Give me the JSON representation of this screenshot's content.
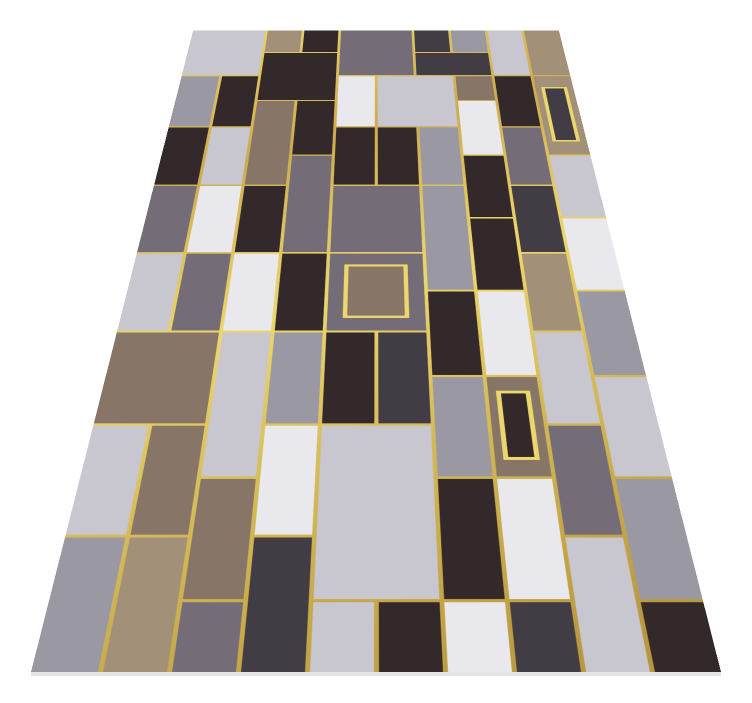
{
  "scene": {
    "background": "#ffffff",
    "description": "geometric-mosaic-rug-product-image"
  },
  "rug": {
    "palette": {
      "dark": "#33282a",
      "charcoal": "#423c44",
      "gray": "#746d77",
      "silver": "#9a98a2",
      "lightgray": "#c8c6ce",
      "white": "#e9e8ec",
      "taupe": "#877668",
      "tan": "#a29079",
      "gold": "#cdab50",
      "gold_light": "#ecd76c",
      "gold_dark": "#b39138"
    },
    "grid": {
      "cols": 10,
      "rows": 16,
      "cell_w": 69,
      "cell_h": 107
    },
    "perspective": {
      "width": 690,
      "center_x": 376,
      "bottom_y": 672,
      "top_y": 30,
      "top_width": 366,
      "rotate_x_deg": 45,
      "perspective_px": 1365
    },
    "line_half_width": 2.5,
    "tiles": [
      {
        "x": 0,
        "y": 0,
        "w": 2,
        "h": 2,
        "color": "lightgray"
      },
      {
        "x": 2,
        "y": 0,
        "w": 1,
        "h": 1,
        "color": "tan"
      },
      {
        "x": 3,
        "y": 0,
        "w": 1,
        "h": 1,
        "color": "dark"
      },
      {
        "x": 4,
        "y": 0,
        "w": 2,
        "h": 2,
        "color": "gray"
      },
      {
        "x": 6,
        "y": 0,
        "w": 1,
        "h": 1,
        "color": "charcoal"
      },
      {
        "x": 7,
        "y": 0,
        "w": 1,
        "h": 1,
        "color": "silver"
      },
      {
        "x": 8,
        "y": 0,
        "w": 1,
        "h": 2,
        "color": "lightgray"
      },
      {
        "x": 9,
        "y": 0,
        "w": 1,
        "h": 2,
        "color": "tan"
      },
      {
        "x": 2,
        "y": 1,
        "w": 2,
        "h": 2,
        "color": "dark"
      },
      {
        "x": 6,
        "y": 1,
        "w": 2,
        "h": 1,
        "color": "charcoal"
      },
      {
        "x": 0,
        "y": 2,
        "w": 1,
        "h": 2,
        "color": "silver"
      },
      {
        "x": 1,
        "y": 2,
        "w": 1,
        "h": 2,
        "color": "dark"
      },
      {
        "x": 4,
        "y": 2,
        "w": 1,
        "h": 2,
        "color": "white"
      },
      {
        "x": 5,
        "y": 2,
        "w": 2,
        "h": 2,
        "color": "lightgray"
      },
      {
        "x": 7,
        "y": 2,
        "w": 1,
        "h": 1,
        "color": "taupe"
      },
      {
        "x": 8,
        "y": 2,
        "w": 1,
        "h": 2,
        "color": "dark"
      },
      {
        "x": 9,
        "y": 2,
        "w": 1,
        "h": 3,
        "color": "tan",
        "inset": "charcoal"
      },
      {
        "x": 2,
        "y": 3,
        "w": 1,
        "h": 3,
        "color": "taupe"
      },
      {
        "x": 3,
        "y": 3,
        "w": 1,
        "h": 2,
        "color": "dark"
      },
      {
        "x": 7,
        "y": 3,
        "w": 1,
        "h": 2,
        "color": "white"
      },
      {
        "x": 0,
        "y": 4,
        "w": 1,
        "h": 2,
        "color": "dark"
      },
      {
        "x": 1,
        "y": 4,
        "w": 1,
        "h": 2,
        "color": "lightgray"
      },
      {
        "x": 4,
        "y": 4,
        "w": 1,
        "h": 2,
        "color": "dark"
      },
      {
        "x": 5,
        "y": 4,
        "w": 1,
        "h": 2,
        "color": "dark"
      },
      {
        "x": 6,
        "y": 4,
        "w": 1,
        "h": 2,
        "color": "silver"
      },
      {
        "x": 8,
        "y": 4,
        "w": 1,
        "h": 2,
        "color": "gray"
      },
      {
        "x": 7,
        "y": 5,
        "w": 1,
        "h": 2,
        "color": "dark"
      },
      {
        "x": 9,
        "y": 5,
        "w": 1,
        "h": 2,
        "color": "lightgray"
      },
      {
        "x": 3,
        "y": 5,
        "w": 1,
        "h": 3,
        "color": "gray"
      },
      {
        "x": 0,
        "y": 6,
        "w": 1,
        "h": 2,
        "color": "gray"
      },
      {
        "x": 1,
        "y": 6,
        "w": 1,
        "h": 2,
        "color": "white"
      },
      {
        "x": 2,
        "y": 6,
        "w": 1,
        "h": 2,
        "color": "dark"
      },
      {
        "x": 4,
        "y": 6,
        "w": 2,
        "h": 2,
        "color": "gray"
      },
      {
        "x": 6,
        "y": 6,
        "w": 1,
        "h": 3,
        "color": "silver"
      },
      {
        "x": 8,
        "y": 6,
        "w": 1,
        "h": 2,
        "color": "charcoal"
      },
      {
        "x": 7,
        "y": 7,
        "w": 1,
        "h": 2,
        "color": "dark"
      },
      {
        "x": 9,
        "y": 7,
        "w": 1,
        "h": 2,
        "color": "white"
      },
      {
        "x": 0,
        "y": 8,
        "w": 1,
        "h": 2,
        "color": "lightgray"
      },
      {
        "x": 1,
        "y": 8,
        "w": 1,
        "h": 2,
        "color": "gray"
      },
      {
        "x": 2,
        "y": 8,
        "w": 1,
        "h": 2,
        "color": "white"
      },
      {
        "x": 3,
        "y": 8,
        "w": 1,
        "h": 2,
        "color": "dark"
      },
      {
        "x": 4,
        "y": 8,
        "w": 2,
        "h": 2,
        "color": "gray",
        "inset": "taupe"
      },
      {
        "x": 8,
        "y": 8,
        "w": 1,
        "h": 2,
        "color": "tan"
      },
      {
        "x": 6,
        "y": 9,
        "w": 1,
        "h": 2,
        "color": "dark"
      },
      {
        "x": 7,
        "y": 9,
        "w": 1,
        "h": 2,
        "color": "white"
      },
      {
        "x": 9,
        "y": 9,
        "w": 1,
        "h": 2,
        "color": "silver"
      },
      {
        "x": 0,
        "y": 10,
        "w": 2,
        "h": 2,
        "color": "taupe"
      },
      {
        "x": 2,
        "y": 10,
        "w": 1,
        "h": 3,
        "color": "lightgray"
      },
      {
        "x": 3,
        "y": 10,
        "w": 1,
        "h": 2,
        "color": "silver"
      },
      {
        "x": 4,
        "y": 10,
        "w": 1,
        "h": 2,
        "color": "dark"
      },
      {
        "x": 5,
        "y": 10,
        "w": 1,
        "h": 2,
        "color": "charcoal"
      },
      {
        "x": 8,
        "y": 10,
        "w": 1,
        "h": 2,
        "color": "lightgray"
      },
      {
        "x": 6,
        "y": 11,
        "w": 1,
        "h": 2,
        "color": "silver"
      },
      {
        "x": 7,
        "y": 11,
        "w": 1,
        "h": 2,
        "color": "taupe",
        "inset": "dark"
      },
      {
        "x": 9,
        "y": 11,
        "w": 1,
        "h": 2,
        "color": "lightgray"
      },
      {
        "x": 0,
        "y": 12,
        "w": 1,
        "h": 2,
        "color": "lightgray"
      },
      {
        "x": 1,
        "y": 12,
        "w": 1,
        "h": 2,
        "color": "taupe"
      },
      {
        "x": 3,
        "y": 12,
        "w": 1,
        "h": 2,
        "color": "white"
      },
      {
        "x": 4,
        "y": 12,
        "w": 2,
        "h": 3,
        "color": "lightgray"
      },
      {
        "x": 8,
        "y": 12,
        "w": 1,
        "h": 2,
        "color": "gray"
      },
      {
        "x": 2,
        "y": 13,
        "w": 1,
        "h": 2,
        "color": "taupe"
      },
      {
        "x": 6,
        "y": 13,
        "w": 1,
        "h": 2,
        "color": "dark"
      },
      {
        "x": 7,
        "y": 13,
        "w": 1,
        "h": 2,
        "color": "white"
      },
      {
        "x": 9,
        "y": 13,
        "w": 1,
        "h": 2,
        "color": "silver"
      },
      {
        "x": 0,
        "y": 14,
        "w": 1,
        "h": 2,
        "color": "silver"
      },
      {
        "x": 1,
        "y": 14,
        "w": 1,
        "h": 2,
        "color": "tan"
      },
      {
        "x": 3,
        "y": 14,
        "w": 1,
        "h": 2,
        "color": "charcoal"
      },
      {
        "x": 8,
        "y": 14,
        "w": 1,
        "h": 2,
        "color": "lightgray"
      },
      {
        "x": 2,
        "y": 15,
        "w": 1,
        "h": 1,
        "color": "gray"
      },
      {
        "x": 4,
        "y": 15,
        "w": 1,
        "h": 1,
        "color": "lightgray"
      },
      {
        "x": 5,
        "y": 15,
        "w": 1,
        "h": 1,
        "color": "dark"
      },
      {
        "x": 6,
        "y": 15,
        "w": 1,
        "h": 1,
        "color": "white"
      },
      {
        "x": 7,
        "y": 15,
        "w": 1,
        "h": 1,
        "color": "charcoal"
      },
      {
        "x": 9,
        "y": 15,
        "w": 1,
        "h": 1,
        "color": "dark"
      }
    ]
  }
}
